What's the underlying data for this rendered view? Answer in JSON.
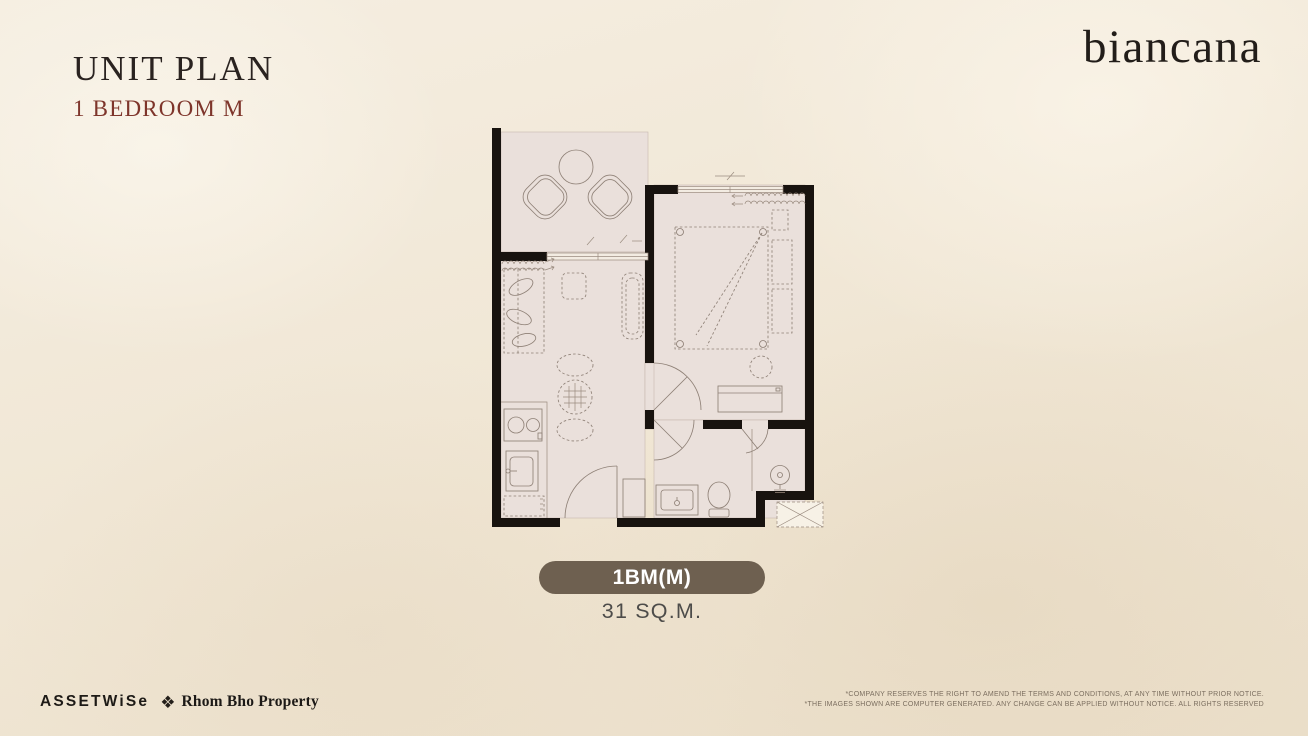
{
  "header": {
    "title": "UNIT PLAN",
    "subtitle": "1 BEDROOM M"
  },
  "brand": {
    "logo_text": "biancana"
  },
  "unit": {
    "badge_label": "1BM(M)",
    "area_text": "31 SQ.M."
  },
  "floor_plan": {
    "type": "1-bedroom condominium unit plan",
    "icon_names": [
      "balcony-lounge-chairs",
      "balcony-round-table",
      "sofa",
      "ottoman",
      "tv-console",
      "dining-table",
      "dining-chairs",
      "kitchen-stove",
      "kitchen-sink",
      "entrance-door-arc",
      "bed",
      "pillows",
      "bedroom-curtain",
      "living-curtain",
      "stool",
      "dresser",
      "bathroom-vanity",
      "toilet",
      "shower-head",
      "ac-unit"
    ]
  },
  "footer": {
    "developer_logo_text": "ASSETWiSe",
    "partner_logo_text": "Rhom Bho Property",
    "partner_icon": "diamond-cluster-icon",
    "disclaimer_lines": [
      "*COMPANY RESERVES THE RIGHT TO AMEND THE TERMS AND CONDITIONS, AT ANY TIME WITHOUT PRIOR NOTICE.",
      "*THE IMAGES SHOWN ARE COMPUTER GENERATED. ANY CHANGE CAN BE APPLIED WITHOUT NOTICE. ALL RIGHTS RESERVED"
    ]
  },
  "colors": {
    "background_cream": "#f1e8d8",
    "accent_brown": "#6e6050",
    "subtitle_red": "#7e352b",
    "wall_black": "#18130f",
    "floor_pink": "#eae0db"
  }
}
